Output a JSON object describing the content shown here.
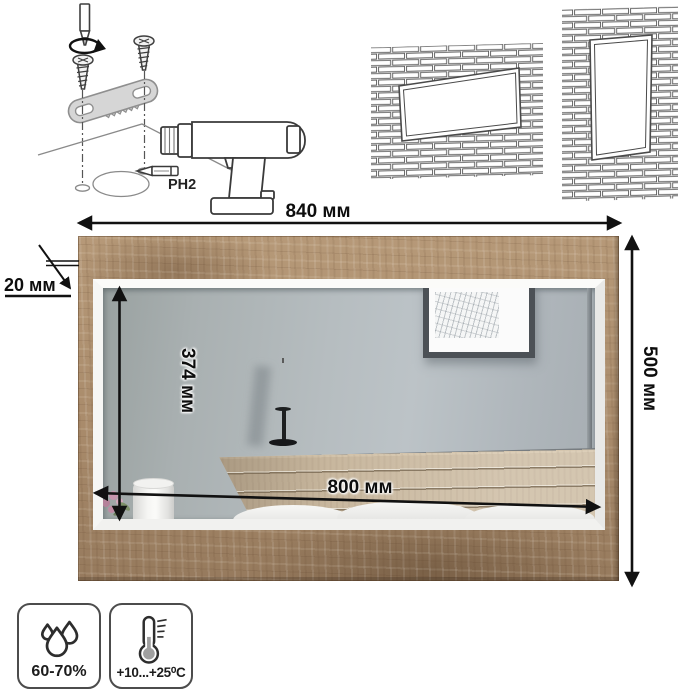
{
  "assembly": {
    "bit_label": "PH2"
  },
  "dimensions": {
    "overall_width": "840 мм",
    "overall_height": "500 мм",
    "mirror_height": "374 мм",
    "mirror_width": "800 мм",
    "frame_thickness": "20 мм"
  },
  "conditions": {
    "humidity": "60-70%",
    "temperature": "+10...+25⁰С"
  },
  "colors": {
    "frame_wood": "#ad9171",
    "mirror_glass": "#b6bdc0",
    "headboard_wood": "#c8b79e",
    "dimension_line": "#111111",
    "bracket_gray": "#d6d6d6"
  }
}
